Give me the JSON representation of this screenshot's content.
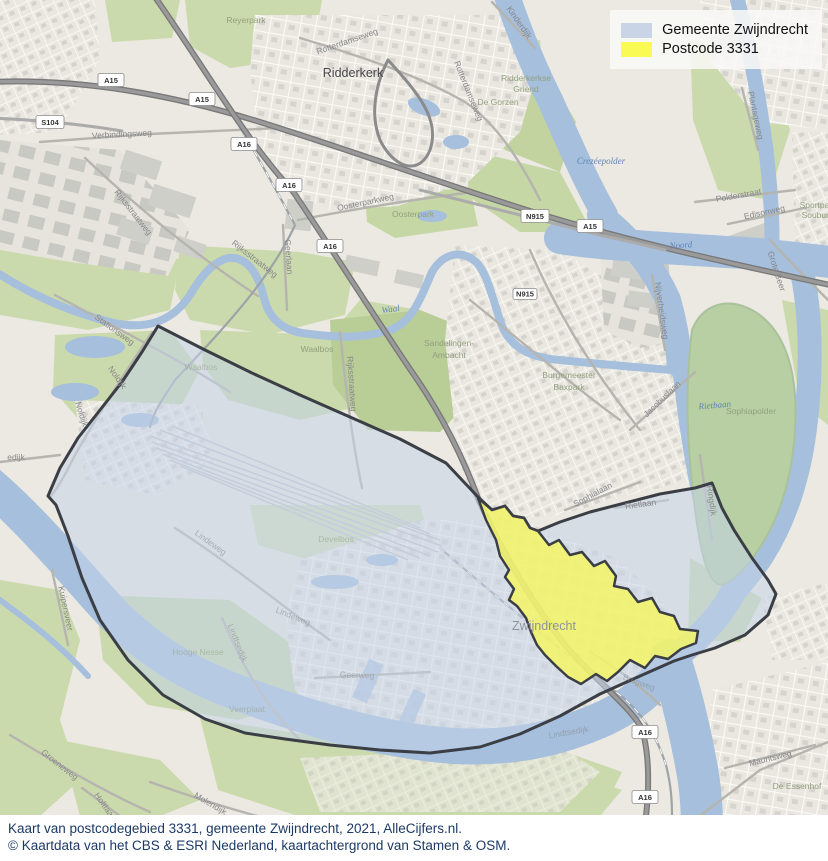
{
  "legend": {
    "items": [
      {
        "label": "Gemeente Zwijndrecht",
        "color": "#c9d5e6"
      },
      {
        "label": "Postcode 3331",
        "color": "#fafa55"
      }
    ]
  },
  "caption": {
    "line1": "Kaart van postcodegebied 3331, gemeente Zwijndrecht, 2021, AlleCijfers.nl.",
    "line2": "© Kaartdata van het CBS & ESRI Nederland, kaartachtergrond van Stamen & OSM."
  },
  "map": {
    "regions": [
      {
        "name": "Gemeente Zwijndrecht",
        "fill": "#c5d3e9",
        "outline": "#3b3f45"
      },
      {
        "name": "Postcode 3331",
        "fill": "#f6f65e",
        "outline": "#3b3f45"
      }
    ],
    "towns": [
      {
        "t": "Ridderkerk"
      },
      {
        "t": "Zwijndrecht"
      }
    ],
    "areas": [
      {
        "t": "Reyerpark"
      },
      {
        "t": "De Gorzen"
      },
      {
        "t": "Ridderkerkse"
      },
      {
        "t": "Griend"
      },
      {
        "t": "Oosterpark"
      },
      {
        "t": "Waalbos"
      },
      {
        "t": "Waalbos"
      },
      {
        "t": "Sandelingen-"
      },
      {
        "t": "Ambacht"
      },
      {
        "t": "Burgemeester"
      },
      {
        "t": "Baxpark"
      },
      {
        "t": "Hooge Nesse"
      },
      {
        "t": "Veerplaat"
      },
      {
        "t": "Develbos"
      },
      {
        "t": "Sophiapolder"
      },
      {
        "t": "De Essenhof"
      },
      {
        "t": "Sportpark"
      },
      {
        "t": "Souburgh"
      }
    ],
    "streets": [
      {
        "t": "Rotterdamseweg"
      },
      {
        "t": "Rotterdamseweg"
      },
      {
        "t": "Oosterparkweg"
      },
      {
        "t": "Verbindingsweg"
      },
      {
        "t": "Rijksstraatweg"
      },
      {
        "t": "Rijksstraatweg"
      },
      {
        "t": "Rijksstraatweg"
      },
      {
        "t": "Geerlaan"
      },
      {
        "t": "Stationsweg"
      },
      {
        "t": "Noldijk"
      },
      {
        "t": "Noldijk"
      },
      {
        "t": "edijk"
      },
      {
        "t": "Kinderdijk"
      },
      {
        "t": "Plantageweg"
      },
      {
        "t": "Polderstraat"
      },
      {
        "t": "Edisonweg"
      },
      {
        "t": "Grote Beer"
      },
      {
        "t": "Nijverheidsweg"
      },
      {
        "t": "Jacobuslaan"
      },
      {
        "t": "Sophialaan"
      },
      {
        "t": "Rietlaan"
      },
      {
        "t": "Ringdijk"
      },
      {
        "t": "Lindeweg"
      },
      {
        "t": "Lindeweg"
      },
      {
        "t": "Lindtsedijk"
      },
      {
        "t": "Lindtsedijk"
      },
      {
        "t": "Geerweg"
      },
      {
        "t": "Groeneweg"
      },
      {
        "t": "Kuipersveer"
      },
      {
        "t": "Molendijk"
      },
      {
        "t": "Hoftlaan"
      },
      {
        "t": "Brugweg"
      },
      {
        "t": "Mauritsweg"
      }
    ],
    "water_labels": [
      {
        "t": "Noord"
      },
      {
        "t": "Waal"
      },
      {
        "t": "Rietbaan"
      },
      {
        "t": "Crezéepolder"
      }
    ],
    "shields": [
      {
        "t": "A15"
      },
      {
        "t": "A15"
      },
      {
        "t": "A15"
      },
      {
        "t": "A16"
      },
      {
        "t": "A16"
      },
      {
        "t": "A16"
      },
      {
        "t": "A16"
      },
      {
        "t": "A16"
      },
      {
        "t": "S104"
      },
      {
        "t": "N915"
      },
      {
        "t": "N915"
      }
    ]
  }
}
